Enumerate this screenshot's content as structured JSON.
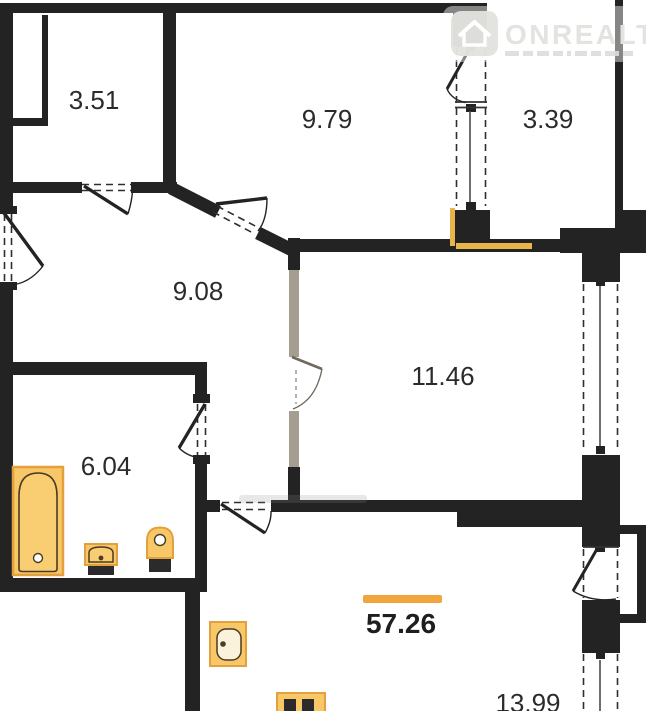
{
  "watermark": {
    "brand": "ONREALT"
  },
  "rooms": [
    {
      "name": "storage",
      "area": "3.51"
    },
    {
      "name": "bedroom",
      "area": "9.79"
    },
    {
      "name": "loggia-top",
      "area": "3.39"
    },
    {
      "name": "hallway",
      "area": "9.08"
    },
    {
      "name": "room",
      "area": "11.46"
    },
    {
      "name": "bathroom",
      "area": "6.04"
    },
    {
      "name": "kitchen-living",
      "area": "13.99"
    }
  ],
  "total_area": "57.26",
  "colors": {
    "wall": "#232323",
    "partition": "#a49d90",
    "fixture_fill": "#F8C868",
    "fixture_stroke": "#E2A13C",
    "accent_orange": "#F0A63C"
  }
}
